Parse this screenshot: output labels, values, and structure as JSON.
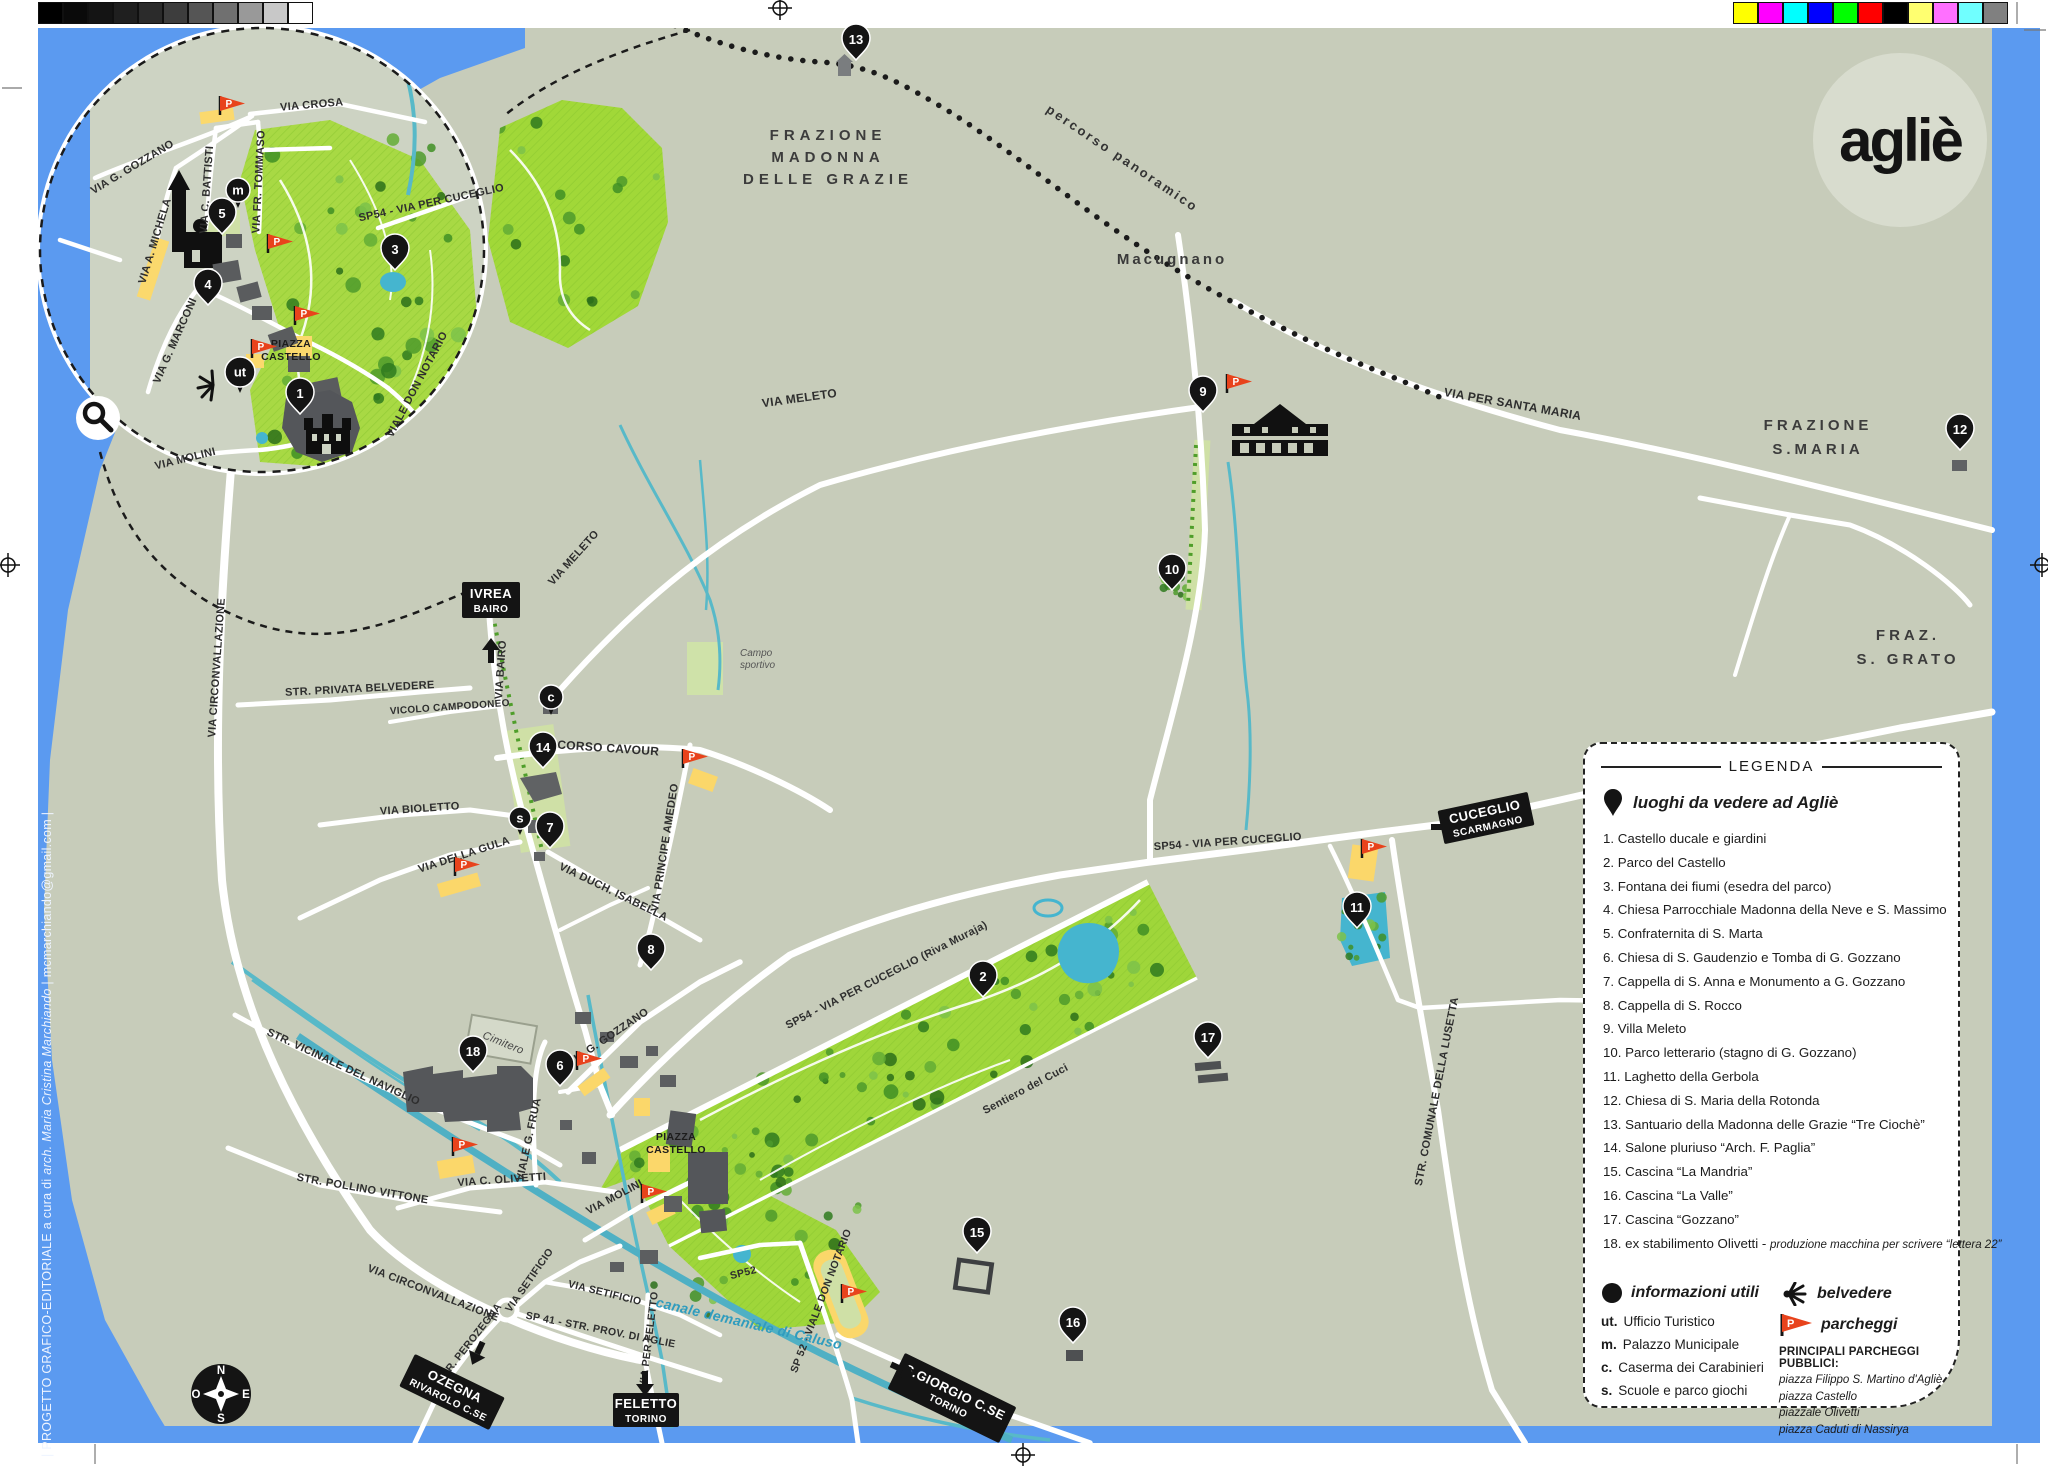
{
  "print": {
    "grayscale": [
      "#000000",
      "#0a0a0a",
      "#141414",
      "#1f1f1f",
      "#2b2b2b",
      "#3d3d3d",
      "#555555",
      "#707070",
      "#999999",
      "#c8c8c8",
      "#ffffff"
    ],
    "colorbar": [
      "#ffff00",
      "#ff00ff",
      "#00ffff",
      "#0000ff",
      "#00ff00",
      "#ff0000",
      "#000000",
      "#ffff70",
      "#ff70ff",
      "#70ffff",
      "#808080"
    ],
    "credit_pre": "| PROGETTO GRAFICO-EDITORIALE  a cura di ",
    "credit_italic": "arch. Maria Cristina Marchiando",
    "credit_post": " | mcmarchiando@gmail.com |"
  },
  "logo": {
    "text": "agliè"
  },
  "inset": {
    "street_labels": [
      {
        "t": "VIA CROSA"
      },
      {
        "t": "VIA G. GOZZANO"
      },
      {
        "t": "VIA A. MICHELA"
      },
      {
        "t": "VIA C. BATTISTI"
      },
      {
        "t": "VIA FR. TOMMASO"
      },
      {
        "t": "SP54 - VIA PER CUCEGLIO"
      },
      {
        "t": "VIA G. MARCONI"
      },
      {
        "t": "VIALE DON NOTARIO"
      },
      {
        "t": "VIA MOLINI"
      }
    ]
  },
  "map": {
    "road_labels": [
      {
        "t": "VIA MELETO"
      },
      {
        "t": "VIA MELETO"
      },
      {
        "t": "STR. PRIVATA BELVEDERE"
      },
      {
        "t": "CORSO CAVOUR"
      },
      {
        "t": "VIA BAIRO"
      },
      {
        "t": "VIA BIOLETTO"
      },
      {
        "t": "VIA DELLA GULA"
      },
      {
        "t": "VICOLO CAMPODONEO"
      },
      {
        "t": "VIA DUCH. ISABELLA"
      },
      {
        "t": "VIA PRINCIPE AMEDEO"
      },
      {
        "t": "VIA CIRCONVALLAZIONE"
      },
      {
        "t": "VIA CIRCONVALLAZIONE"
      },
      {
        "t": "STR. VICINALE DEL NAVIGLIO"
      },
      {
        "t": "STR. POLLINO VITTONE"
      },
      {
        "t": "VIA C. OLIVETTI"
      },
      {
        "t": "VIALE G. FRUA"
      },
      {
        "t": "VIA G. GOZZANO"
      },
      {
        "t": "VIA MOLINI"
      },
      {
        "t": "VIA SETIFICIO"
      },
      {
        "t": "VIA SETIFICIO"
      },
      {
        "t": "STR. PEROZEGNA"
      },
      {
        "t": "SP 41 - STR. PROV. DI AGLIE"
      },
      {
        "t": "VIA PER FELETTO"
      },
      {
        "t": "SP52"
      },
      {
        "t": "SP 52 - VIALE DON NOTARIO"
      },
      {
        "t": "canale demaniale di Caluso"
      },
      {
        "t": "SP54 - VIA PER CUCEGLIO"
      },
      {
        "t": "SP54 - VIA PER CUCEGLIO   (Riva Muraja)"
      },
      {
        "t": "Sentiero del Cuci"
      },
      {
        "t": "VIA PER SANTA MARIA"
      },
      {
        "t": "STR. COMUNALE DELLA LUSETTA"
      },
      {
        "t": "percorso panoramico"
      },
      {
        "t": "Cimitero"
      },
      {
        "t": "Macugnano"
      }
    ],
    "multiline_labels": [
      {
        "lines": [
          "FRAZIONE",
          "MADONNA",
          "DELLE GRAZIE"
        ]
      },
      {
        "lines": [
          "FRAZIONE",
          "S.MARIA"
        ]
      },
      {
        "lines": [
          "FRAZ.",
          "S. GRATO"
        ]
      },
      {
        "lines": [
          "Campo",
          "sportivo"
        ]
      },
      {
        "lines": [
          "PIAZZA",
          "CASTELLO"
        ]
      },
      {
        "lines": [
          "PIAZZA",
          "CASTELLO"
        ]
      }
    ],
    "signs": [
      {
        "l1": "IVREA",
        "l2": "BAIRO"
      },
      {
        "l1": "CUCEGLIO",
        "l2": "SCARMAGNO"
      },
      {
        "l1": "OZEGNA",
        "l2": "RIVAROLO C.SE"
      },
      {
        "l1": "FELETTO",
        "l2": "TORINO"
      },
      {
        "l1": "S.GIORGIO C.SE",
        "l2": "TORINO"
      }
    ],
    "pins": [
      {
        "n": "1"
      },
      {
        "n": "3"
      },
      {
        "n": "4"
      },
      {
        "n": "5"
      },
      {
        "n": "2"
      },
      {
        "n": "6"
      },
      {
        "n": "7"
      },
      {
        "n": "8"
      },
      {
        "n": "9"
      },
      {
        "n": "10"
      },
      {
        "n": "11"
      },
      {
        "n": "12"
      },
      {
        "n": "13"
      },
      {
        "n": "14"
      },
      {
        "n": "15"
      },
      {
        "n": "16"
      },
      {
        "n": "17"
      },
      {
        "n": "18"
      }
    ],
    "letter_markers": [
      {
        "t": "m"
      },
      {
        "t": "ut"
      },
      {
        "t": "c"
      },
      {
        "t": "s"
      }
    ],
    "parking_letter": "P",
    "compass": {
      "n": "N",
      "s": "S",
      "e": "E",
      "w": "O"
    }
  },
  "legend": {
    "title": "LEGENDA",
    "places_title": "luoghi da vedere ad Agliè",
    "items": [
      "1. Castello ducale e giardini",
      "2. Parco del Castello",
      "3. Fontana dei fiumi (esedra del parco)",
      "4. Chiesa Parrocchiale Madonna della Neve e S. Massimo",
      "5. Confraternita di S. Marta",
      "6. Chiesa di S. Gaudenzio e Tomba di G. Gozzano",
      "7. Cappella di S. Anna e Monumento a G. Gozzano",
      "8. Cappella di S. Rocco",
      "9. Villa Meleto",
      "10. Parco letterario (stagno di G. Gozzano)",
      "11. Laghetto della Gerbola",
      "12. Chiesa di S. Maria della Rotonda",
      "13. Santuario della Madonna delle Grazie “Tre Ciochè”",
      "14. Salone pluriuso “Arch. F. Paglia”",
      "15. Cascina “La Mandria”",
      "16. Cascina “La Valle”",
      "17. Cascina “Gozzano”",
      "18. ex stabilimento Olivetti -"
    ],
    "item18_note": "produzione macchina per scrivere “lettera 22”",
    "info_title": "informazioni utili",
    "info_items": [
      {
        "k": "ut.",
        "v": "Ufficio Turistico"
      },
      {
        "k": "m.",
        "v": "Palazzo Municipale"
      },
      {
        "k": "c.",
        "v": "Caserma dei Carabinieri"
      },
      {
        "k": "s.",
        "v": "Scuole e parco giochi"
      }
    ],
    "belvedere_label": "belvedere",
    "parking_label": "parcheggi",
    "parking_heading": "PRINCIPALI PARCHEGGI PUBBLICI:",
    "parking_list": [
      "piazza Filippo S. Martino d'Agliè",
      "piazza Castello",
      "piazzale Olivetti",
      "piazza Caduti di Nassirya"
    ]
  }
}
